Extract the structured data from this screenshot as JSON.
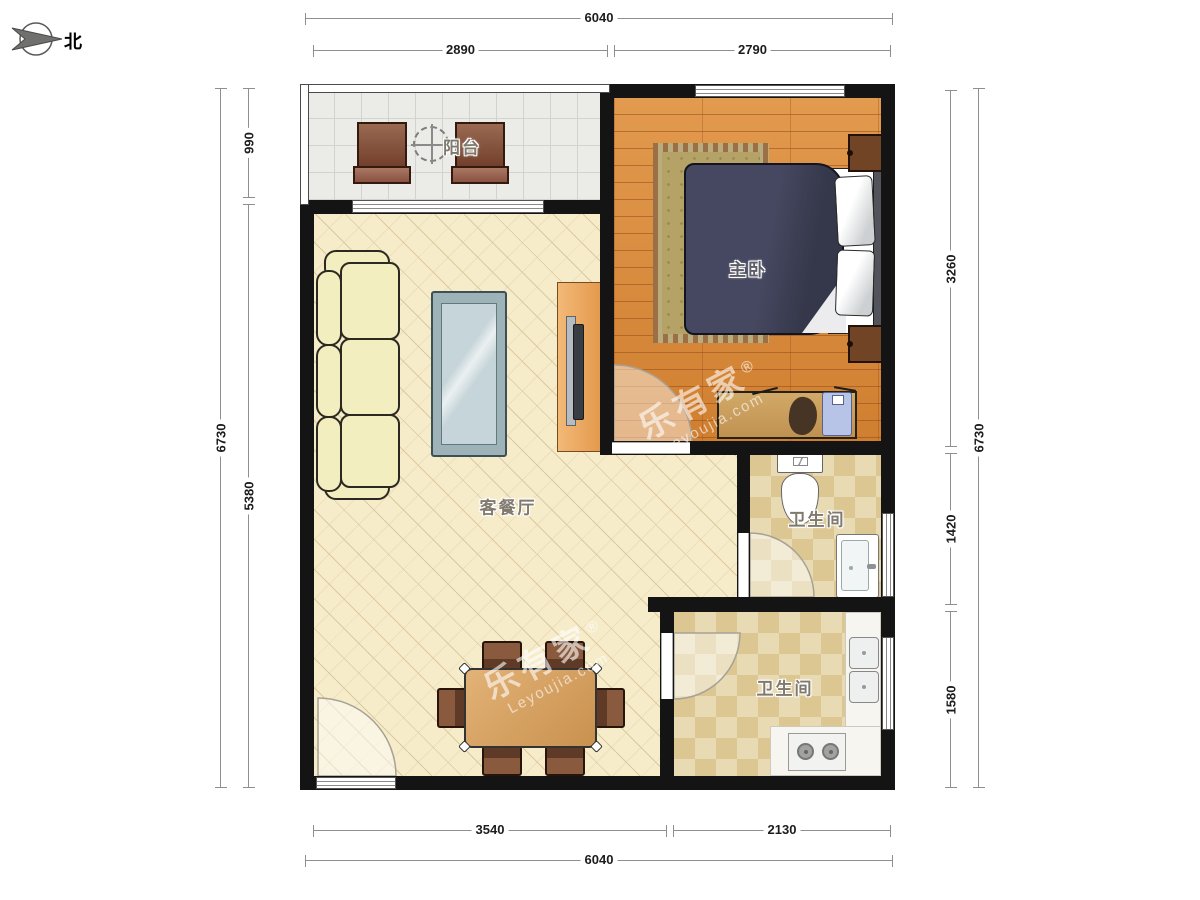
{
  "compass": {
    "label": "北"
  },
  "rooms": {
    "balcony": "阳台",
    "master_bedroom": "主卧",
    "living_dining": "客餐厅",
    "bathroom_1": "卫生间",
    "bathroom_2": "卫生间"
  },
  "dimensions_mm": {
    "top_total": "6040",
    "top_balcony": "2890",
    "top_bedroom": "2790",
    "left_total": "6730",
    "left_balcony": "990",
    "left_living": "5380",
    "right_bedroom": "3260",
    "right_bath1": "1420",
    "right_bath2": "1580",
    "right_total": "6730",
    "bottom_living": "3540",
    "bottom_bath2": "2130",
    "bottom_total": "6040"
  },
  "watermark": {
    "brand_cn": "乐有家",
    "brand_en": "Leyoujia.com",
    "reg": "®"
  },
  "colors": {
    "wall": "#141414",
    "wood_floor": "#dd8d41",
    "living_floor": "#f6ecca",
    "tile_floor": "#e6d7ac",
    "balcony_floor": "#ebebe8",
    "bed": "#3b3d4d",
    "furniture_wood": "#c9914e"
  }
}
